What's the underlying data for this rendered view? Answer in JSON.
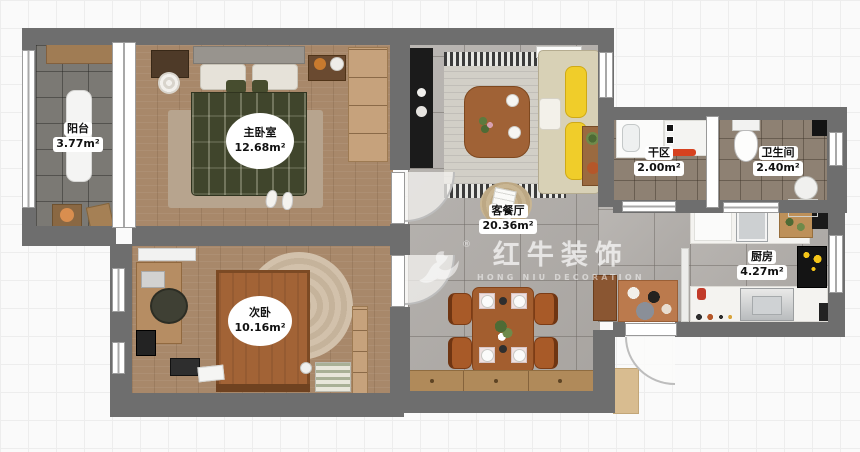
{
  "plan": {
    "watermark": {
      "brand": "红牛装饰",
      "subtitle": "HONG NIU DECORATION",
      "registered": "®"
    },
    "rooms": [
      {
        "id": "balcony",
        "name": "阳台",
        "area": "3.77m²"
      },
      {
        "id": "master-bedroom",
        "name": "主卧室",
        "area": "12.68m²"
      },
      {
        "id": "second-bedroom",
        "name": "次卧",
        "area": "10.16m²"
      },
      {
        "id": "living-dining",
        "name": "客餐厅",
        "area": "20.36m²"
      },
      {
        "id": "dry-area",
        "name": "干区",
        "area": "2.00m²"
      },
      {
        "id": "bathroom",
        "name": "卫生间",
        "area": "2.40m²"
      },
      {
        "id": "kitchen",
        "name": "厨房",
        "area": "4.27m²"
      }
    ],
    "colors": {
      "wall": "#6e6e6e",
      "wood_floor": "#a8886a",
      "tile_floor": "#b2aeaa",
      "balcony_floor": "#7b7974",
      "bath_floor": "#8e8173",
      "master_bed_green": "#40452c",
      "second_bed_brown": "#a26336",
      "sofa_pillow_yellow": "#f0cd2a",
      "towel_red": "#d64220",
      "dining_wood": "#a35e2f"
    }
  }
}
